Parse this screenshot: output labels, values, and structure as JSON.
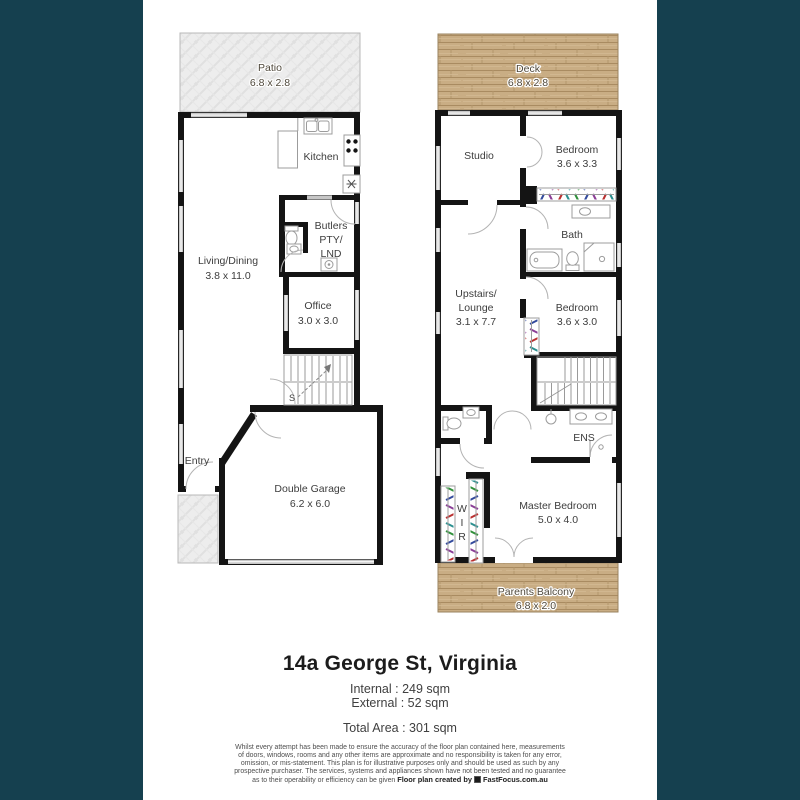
{
  "colors": {
    "background": "#15404f",
    "sheet": "#ffffff",
    "wall": "#141414",
    "deck_wood": "#c9ad84",
    "patio_paving": "#ededed"
  },
  "ground_floor": {
    "patio": {
      "name": "Patio",
      "dims": "6.8 x 2.8"
    },
    "kitchen": {
      "name": "Kitchen"
    },
    "butlers": {
      "line1": "Butlers",
      "line2": "PTY/",
      "line3": "LND"
    },
    "living_dining": {
      "name": "Living/Dining",
      "dims": "3.8 x 11.0"
    },
    "office": {
      "name": "Office",
      "dims": "3.0 x 3.0"
    },
    "stairs": {
      "label": "S"
    },
    "entry": {
      "name": "Entry"
    },
    "garage": {
      "name": "Double Garage",
      "dims": "6.2 x 6.0"
    }
  },
  "upper_floor": {
    "deck": {
      "name": "Deck",
      "dims": "6.8 x 2.8"
    },
    "studio": {
      "name": "Studio"
    },
    "bedroom_front": {
      "name": "Bedroom",
      "dims": "3.6 x 3.3"
    },
    "bath": {
      "name": "Bath"
    },
    "lounge": {
      "line1": "Upstairs/",
      "line2": "Lounge",
      "dims": "3.1 x 7.7"
    },
    "bedroom_mid": {
      "name": "Bedroom",
      "dims": "3.6 x 3.0"
    },
    "ens": {
      "name": "ENS"
    },
    "master_bedroom": {
      "name": "Master Bedroom",
      "dims": "5.0 x 4.0"
    },
    "wir": {
      "l1": "W",
      "l2": "I",
      "l3": "R"
    },
    "balcony": {
      "name": "Parents Balcony",
      "dims": "6.8 x 2.0"
    }
  },
  "summary": {
    "title": "14a George St, Virginia",
    "internal": "Internal : 249 sqm",
    "external": "External : 52 sqm",
    "total": "Total Area : 301 sqm"
  },
  "footer": {
    "disclaimer": "Whilst every attempt has been made to ensure the accuracy of the floor plan contained here, measurements of doors, windows, rooms and any other items are approximate and no responsibility is taken for any error, omission, or mis-statement. This plan is for illustrative purposes only and should be used as such by any prospective purchaser. The services, systems and appliances shown have not been tested and no guarantee as to their operability or efficiency can be given",
    "credit": "Floor plan created by",
    "brand": "FastFocus.com.au"
  }
}
